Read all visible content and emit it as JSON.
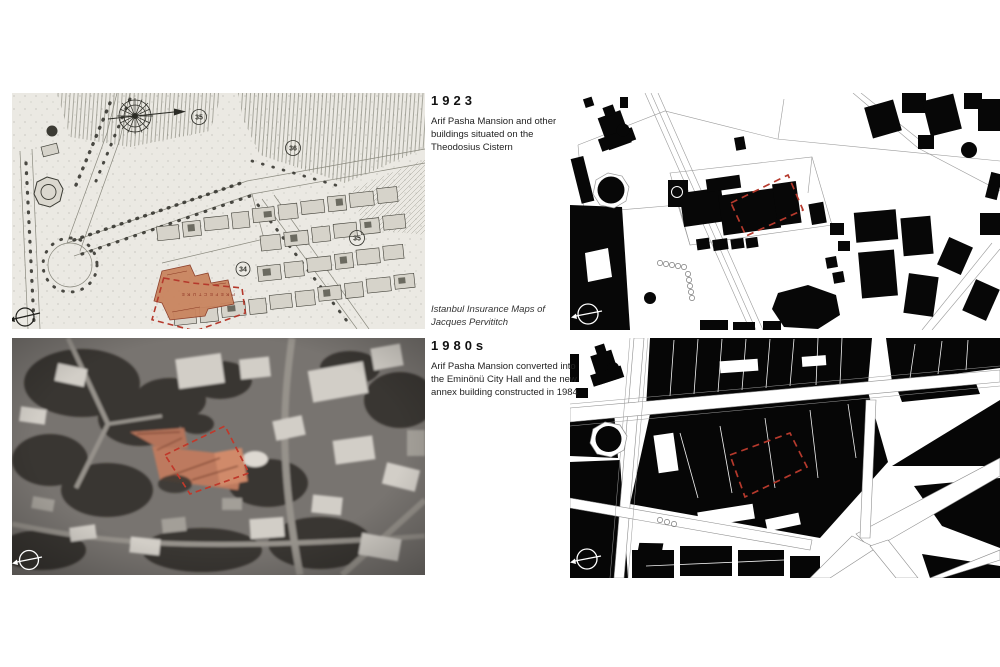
{
  "text_column": {
    "year_1923": "1923",
    "desc_1923": "Arif Pasha Mansion and other buildings situated on the Theodosius Cistern",
    "source_caption": "Istanbul Insurance Maps of Jacques Pervititch",
    "year_1980s": "1980s",
    "desc_1980s": "Arif Pasha Mansion converted into the Eminönü City Hall and the new annex building constructed in 1984"
  },
  "historic_map": {
    "circled_numbers": [
      "35",
      "36",
      "35",
      "34"
    ],
    "street_label": "PREFECTURE"
  },
  "panels": {
    "pervititch_map": "1923 Pervititch insurance map with Arif Pasha Mansion highlighted",
    "figure_ground_1923": "1923 figure-ground plan with site boundary",
    "aerial_1980s": "1980s aerial photograph with mansion highlighted",
    "figure_ground_1980s": "1980s figure-ground plan with site boundary"
  },
  "colors": {
    "site_boundary_red": "#b5392c",
    "mansion_highlight": "#c9845f",
    "building_black": "#070707",
    "map_paper": "#ebe9e3"
  }
}
